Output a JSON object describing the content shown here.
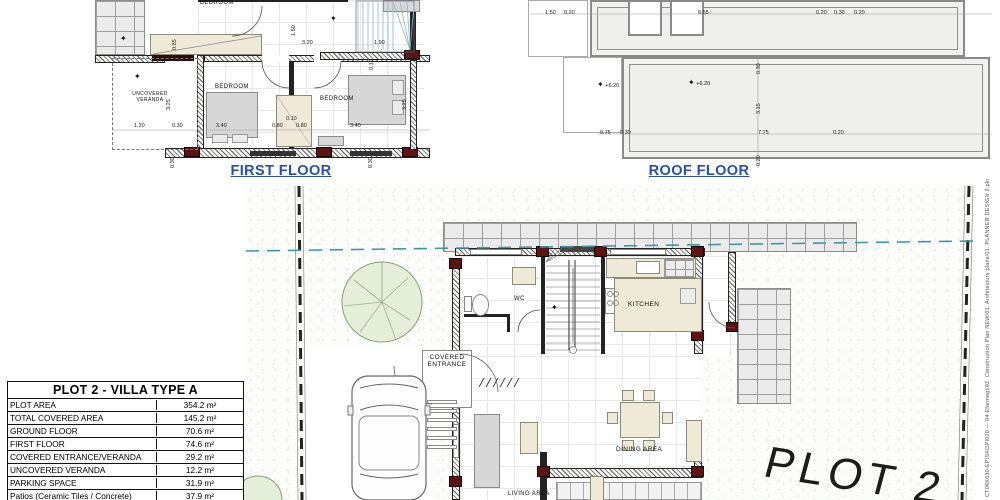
{
  "titles": {
    "first_floor": "FIRST FLOOR",
    "roof_floor": "ROOF FLOOR"
  },
  "ff": {
    "bed_top": "BEDROOM",
    "bed_left": "BEDROOM",
    "bed_right": "BEDROOM",
    "veranda": "UNCOVERED VERANDA"
  },
  "gf": {
    "wc": "WC",
    "kitchen": "KITCHEN",
    "entrance": "COVERED ENTRANCE",
    "living": "LIVING AREA",
    "dining": "DINING AREA",
    "plot": "PLOT 2"
  },
  "dims": {
    "ff": [
      {
        "t": "1.20",
        "x": 134,
        "y": 123
      },
      {
        "t": "0.30",
        "x": 172,
        "y": 123
      },
      {
        "t": "3.40",
        "x": 216,
        "y": 123
      },
      {
        "t": "0.80",
        "x": 272,
        "y": 123
      },
      {
        "t": "0.10",
        "x": 286,
        "y": 116
      },
      {
        "t": "0.80",
        "x": 296,
        "y": 123
      },
      {
        "t": "3.40",
        "x": 350,
        "y": 123
      },
      {
        "t": "3.20",
        "x": 302,
        "y": 40
      },
      {
        "t": "1.90",
        "x": 374,
        "y": 40
      },
      {
        "t": "1.60",
        "x": 291,
        "y": 36,
        "r": -90
      },
      {
        "t": "0.85",
        "x": 172,
        "y": 50,
        "r": -90
      },
      {
        "t": "3.25",
        "x": 166,
        "y": 110,
        "r": -90
      },
      {
        "t": "3.25",
        "x": 402,
        "y": 110,
        "r": -90
      },
      {
        "t": "0.10",
        "x": 369,
        "y": 70,
        "r": -90
      },
      {
        "t": "0.30",
        "x": 170,
        "y": 168,
        "r": -90
      },
      {
        "t": "0.30",
        "x": 368,
        "y": 168,
        "r": -90
      }
    ],
    "roof": [
      {
        "t": "1.50",
        "x": 545,
        "y": 10
      },
      {
        "t": "0.20",
        "x": 564,
        "y": 10
      },
      {
        "t": "8.55",
        "x": 698,
        "y": 10
      },
      {
        "t": "0.20",
        "x": 816,
        "y": 10
      },
      {
        "t": "0.30",
        "x": 834,
        "y": 10
      },
      {
        "t": "0.20",
        "x": 854,
        "y": 10
      },
      {
        "t": "0.75",
        "x": 600,
        "y": 130
      },
      {
        "t": "0.30",
        "x": 620,
        "y": 130
      },
      {
        "t": "7.75",
        "x": 758,
        "y": 130
      },
      {
        "t": "0.20",
        "x": 833,
        "y": 130
      },
      {
        "t": "0.30",
        "x": 756,
        "y": 74,
        "r": -90
      },
      {
        "t": "3.15",
        "x": 756,
        "y": 114,
        "r": -90
      },
      {
        "t": "0.20",
        "x": 756,
        "y": 166,
        "r": -90
      }
    ],
    "elevs": [
      {
        "t": "+6.20",
        "x": 597,
        "y": 80
      },
      {
        "t": "+6.20",
        "x": 688,
        "y": 78
      },
      {
        "t": "",
        "x": 120,
        "y": 34
      },
      {
        "t": "",
        "x": 134,
        "y": 72
      },
      {
        "t": "",
        "x": 330,
        "y": 14
      },
      {
        "t": "",
        "x": 551,
        "y": 303
      }
    ]
  },
  "table": {
    "title": "PLOT 2 - VILLA TYPE A",
    "rows": [
      {
        "label": "PLOT AREA",
        "value": "354.2 m²"
      },
      {
        "label": "TOTAL COVERED AREA",
        "value": "145.2 m²"
      },
      {
        "label": "GROUND FLOOR",
        "value": "70.6 m²"
      },
      {
        "label": "FIRST FLOOR",
        "value": "74.6 m²"
      },
      {
        "label": "COVERED ENTRANCE/VERANDA",
        "value": "29.2 m²"
      },
      {
        "label": "UNCOVERED VERANDA",
        "value": "12.2 m²"
      },
      {
        "label": "PARKING SPACE",
        "value": "31.9 m²"
      },
      {
        "label": "Patios (Ceramic Tiles / Concrete)",
        "value": "37.9 m²"
      }
    ]
  },
  "side_text": "CT06K030-EPISKOPI020 — 04 Efarmogi/02. Construction Plan NEW/01. Architecture plans/01. PLANNER DESIGN 2.pln",
  "colors": {
    "title_blue": "#2b4fa4",
    "setback_teal": "#4396a6",
    "column_red": "#5a1512",
    "counter_cream": "#efe9d8",
    "tree_green": "#e4eed9"
  }
}
